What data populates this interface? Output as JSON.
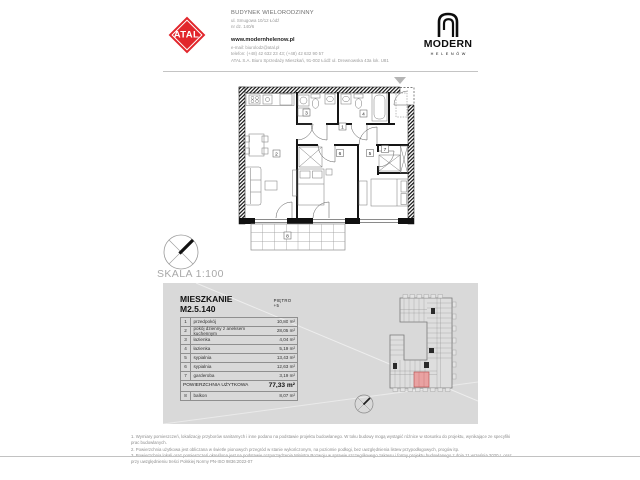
{
  "header": {
    "atal_logo_text": "ATAL",
    "building_title": "BUDYNEK WIELORODZINNY",
    "building_address": "ul. Smugowa 10/12 Łódź",
    "building_plot": "nr dz. 140/6",
    "website": "www.modernhelenow.pl",
    "email": "e-mail: biurolodz@atal.pl",
    "phone": "telefon: (+48) 42 632 23 43; (+48) 42 632 90 57",
    "office": "ATAL S.A. Biuro Sprzedaży Mieszkań, 91-002 Łódź ul. Drewnowska 43a lok. U81",
    "brand_name": "MODERN",
    "brand_sub": "HELENÓW"
  },
  "plan": {
    "scale_label": "SKALA 1:100",
    "room_labels": {
      "r1": "1",
      "r2": "2",
      "r3": "3",
      "r4": "4",
      "r5": "5",
      "r6": "6",
      "r7": "7",
      "r8": "8"
    }
  },
  "apartment": {
    "title": "MIESZKANIE M2.5.140",
    "floor_label": "PIĘTRO +5",
    "rooms": [
      {
        "no": "1",
        "name": "przedpokój",
        "area": "10,80 m²"
      },
      {
        "no": "2",
        "name": "pokój dzienny z aneksem kuchennym",
        "area": "28,05 m²"
      },
      {
        "no": "3",
        "name": "łazienka",
        "area": "4,04 m²"
      },
      {
        "no": "4",
        "name": "łazienka",
        "area": "5,19 m²"
      },
      {
        "no": "5",
        "name": "sypialnia",
        "area": "13,43 m²"
      },
      {
        "no": "6",
        "name": "sypialnia",
        "area": "12,63 m²"
      },
      {
        "no": "7",
        "name": "garderoba",
        "area": "3,19 m²"
      }
    ],
    "total_label": "POWIERZCHNIA UŻYTKOWA",
    "total_area": "77,33 m²",
    "balcony": {
      "no": "8",
      "name": "balkon",
      "area": "8,07 m²"
    }
  },
  "footer": {
    "notes": [
      "1. Wymiary pomieszczeń, lokalizację przyborów sanitarnych i inne podano na podstawie projektu budowlanego. W toku budowy mogą wystąpić różnice w stosunku do projektu, wynikające ze specyfiki prac budowlanych.",
      "2. Powierzchnia użytkowa jest obliczana w świetle pionowych przegród w stanie wykończonym, na poziomie podłogi, bez uwzględnienia listew przypodłogowych, progów itp.",
      "3. Powierzchnia lokali oraz pomieszczeń określona jest na podstawie rozporządzenia Ministra Rozwoju w sprawie szczegółowego zakresu i formy projektu budowlanego z dnia 11 września 2020 r. oraz przy uwzględnieniu treści Polskiej Normy PN-ISO 9836:2022-07"
    ]
  },
  "colors": {
    "brand_red": "#e2262c",
    "unit_highlight": "#e9a2a2",
    "panel_gray": "#d9d9d9"
  }
}
